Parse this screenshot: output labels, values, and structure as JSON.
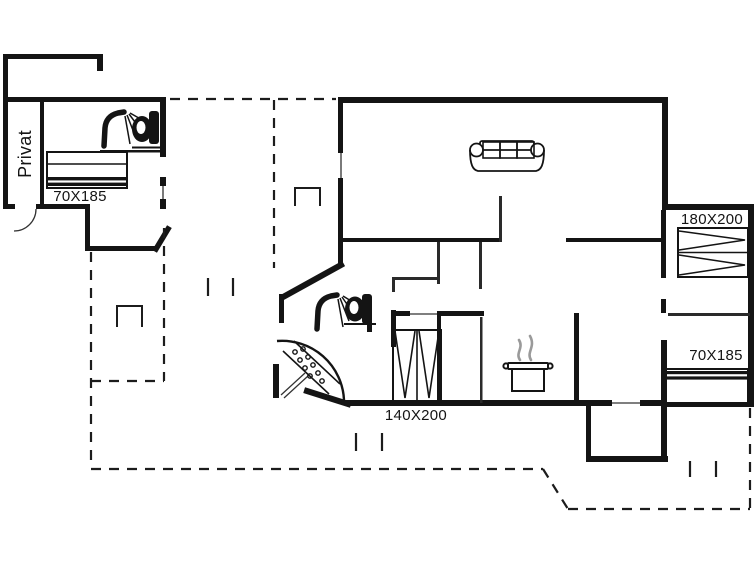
{
  "figure": {
    "type": "floor-plan",
    "description": "Black-and-white architectural floor plan of a holiday house with annex, dashed terrace boundaries, bed sizes and fixture icons"
  },
  "colors": {
    "background": "#ffffff",
    "wall": "#141414",
    "thin_line": "#333333",
    "dash_line": "#1c1c1c",
    "steam": "#9a9a9a"
  },
  "labels": {
    "private_room": "Privat",
    "annex_bed_size": "70X185",
    "master_bed_size": "180X200",
    "right_single_bed_size": "70X185",
    "alcove_bed_size": "140X200"
  },
  "icons": {
    "shower_annex": "shower-icon",
    "toilet_annex": "toilet-icon",
    "shower_main": "shower-icon",
    "toilet_main": "toilet-icon",
    "corner_shower_tray": "corner-shower-icon",
    "sofa": "sofa-icon",
    "cooking_pot": "cooking-pot-icon",
    "beds": [
      "bed-70x185",
      "bed-180x200",
      "bed-70x185",
      "bed-140x200"
    ]
  }
}
